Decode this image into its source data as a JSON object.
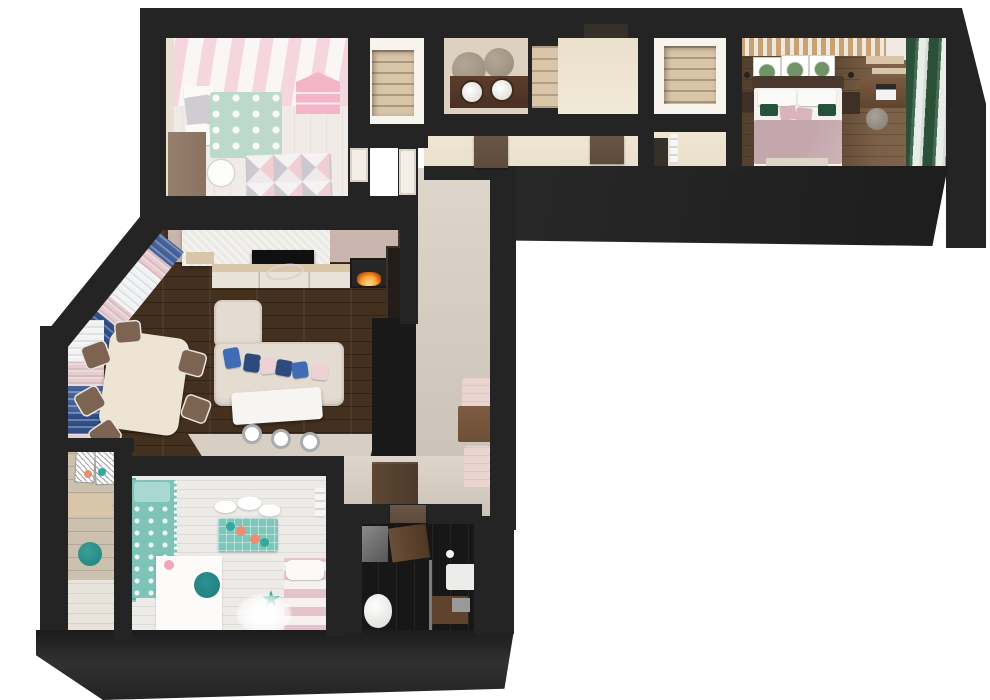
{
  "meta": {
    "type": "3d-floor-plan-render",
    "view": "top-down-dollhouse",
    "canvas": {
      "width": 990,
      "height": 700
    },
    "text_labels": []
  },
  "palette": {
    "bg": "#ffffff",
    "wall": "#242424",
    "floor_pale": "#f1ebe7",
    "stripe_pink": "#f5d5de",
    "stripe_white": "#fbf7f6",
    "wall_beige": "#e9e0d4",
    "mint": "#bcd9cc",
    "pillow_grey": "#cfcdd2",
    "rug_pink": "#f2ccd6",
    "rug_grey": "#c9c7cf",
    "wood_desk": "#8b7260",
    "doll_pink": "#f4b5c9",
    "closet_white": "#f7f3ed",
    "shelf_tan": "#d9c5a8",
    "bath_wall": "#ddd1c1",
    "vanity": "#4a3124",
    "mirror_bronze": "#998b7a",
    "hall_floor": "#e9dfcd",
    "door_brown": "#5d4a3c",
    "slat": "#c8a275",
    "print_green": "#6f9468",
    "headboard": "#4a382c",
    "blanket_mauve": "#c3a7ad",
    "pillow_green": "#24523a",
    "pillow_pink": "#d8b4bd",
    "night_brown": "#3f2f24",
    "curtain_green": "#2c4f3a",
    "living_wood": "#44301f",
    "tv_black": "#101010",
    "wall_mauve": "#c9b5ad",
    "console_white": "#e8e2d8",
    "cabinet_dark": "#241c16",
    "sofa_cream": "#e5dcd1",
    "pillow_blue": "#3f6cb5",
    "pillow_navy": "#2c4a7c",
    "pillow_blush": "#ecd2d6",
    "curtain_blue": "#47639c",
    "curtain_navy": "#31508a",
    "curtain_pink": "#e6cbcf",
    "table_cream": "#ede4d4",
    "chair_brown": "#7d6351",
    "kitchen_black": "#191919",
    "corridor_floor": "#cbc3b7",
    "pouf_pink": "#e9d4d0",
    "bench_brown": "#6e4f38",
    "wardrobe_brown": "#4e3a2a",
    "bath2_floor": "#171717",
    "teal": "#7fc2b8",
    "teal_dark": "#1f7b7b",
    "teal_curtain": "#5fb0a6",
    "coral": "#e88f74",
    "balcony_wood": "#ccc0ae",
    "bed2_pink": "#e5c3cc",
    "flame": "#ffa033"
  },
  "scene": {
    "rooms": [
      {
        "id": "kids-bedroom-1",
        "items": [
          "striped-wallpaper",
          "bed-mint-cloud-blanket",
          "grey-pillow",
          "desk",
          "white-chair",
          "triangle-pattern-rug",
          "dollhouse-shelf",
          "radiator",
          "door"
        ]
      },
      {
        "id": "walk-in-closet-1",
        "items": [
          "shelving-recess"
        ]
      },
      {
        "id": "bathroom-top",
        "items": [
          "double-vanity",
          "round-sink",
          "round-sink",
          "round-mirror",
          "round-mirror",
          "shelf-niche"
        ]
      },
      {
        "id": "entry-hall",
        "items": [
          "entry-door"
        ]
      },
      {
        "id": "hallway",
        "items": [
          "door-brown",
          "door-brown",
          "door-to-living"
        ]
      },
      {
        "id": "walk-in-closet-2",
        "items": [
          "shelving-recess"
        ]
      },
      {
        "id": "bedroom-corridor",
        "items": [
          "radiator",
          "door-recess"
        ]
      },
      {
        "id": "master-bedroom",
        "items": [
          "slat-accent-wall",
          "double-bed",
          "mauve-blanket",
          "green-pillows",
          "pink-pillows",
          "botanical-prints",
          "nightstand",
          "nightstand",
          "wall-sconce",
          "wall-sconce",
          "desk-with-laptop",
          "stool",
          "green-curtains",
          "wood-shelves",
          "plant"
        ]
      },
      {
        "id": "living-dining-room",
        "items": [
          "dark-plank-floor",
          "window-curtains-blue-pink",
          "tv-feature-wall",
          "tv",
          "media-console",
          "floating-shelf",
          "fireplace",
          "display-cabinet",
          "corner-sofa",
          "sofa-pillows",
          "bar-table",
          "bar-stool",
          "bar-stool",
          "bar-stool",
          "dining-table",
          "dining-chairs",
          "kitchen-block",
          "tile-strip"
        ]
      },
      {
        "id": "corridor",
        "items": [
          "pink-pouf-cabinet",
          "wood-bench",
          "pink-pouf-cabinet",
          "wardrobe"
        ]
      },
      {
        "id": "kids-bedroom-2",
        "items": [
          "teal-curtain",
          "teal-bed",
          "white-desk",
          "teal-chair",
          "pink-lamp",
          "cloud-shelves",
          "teal-play-mat",
          "star-pillows",
          "canopy-bed",
          "pink-striped-bed",
          "radiator"
        ]
      },
      {
        "id": "balcony",
        "items": [
          "wall-art",
          "wall-art",
          "shelf",
          "teal-pouf",
          "cabinet",
          "star-pillows"
        ]
      },
      {
        "id": "bathroom-dark",
        "items": [
          "mirror",
          "open-door",
          "wall-hung-sink",
          "toilet",
          "shower-glass",
          "shower-tray",
          "towel",
          "paper-roll"
        ]
      }
    ]
  }
}
